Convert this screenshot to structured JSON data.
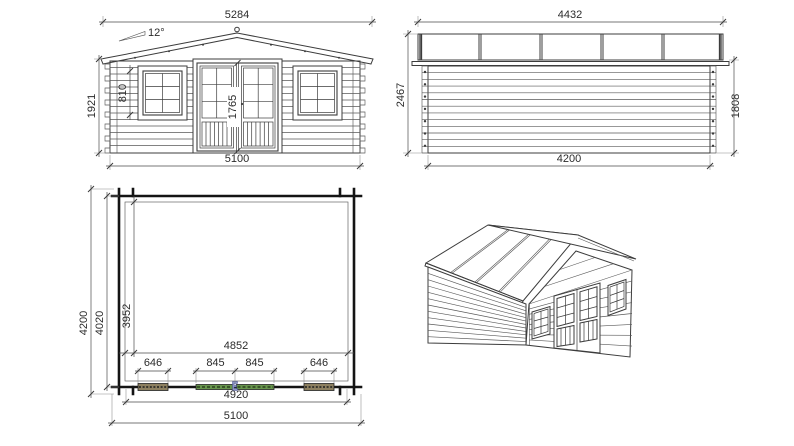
{
  "drawing": {
    "type": "log-cabin technical drawing, four views",
    "views": {
      "front_elevation": {
        "dims": {
          "roof_width": "5284",
          "roof_angle": "12°",
          "wall_height": "1921",
          "window_height": "810",
          "door_height": "1765",
          "wall_width": "5100"
        }
      },
      "side_elevation": {
        "dims": {
          "roof_depth": "4432",
          "overall_height": "2467",
          "wall_height": "1808",
          "wall_depth": "4200"
        }
      },
      "floor_plan": {
        "dims": {
          "overall_depth": "4200",
          "outer_depth": "4020",
          "inner_depth": "3952",
          "inner_width": "4852",
          "window_left_width": "646",
          "door_leaf_left": "845",
          "door_leaf_right": "845",
          "window_right_width": "646",
          "wall_width": "4920",
          "overall_width": "5100"
        }
      },
      "perspective": {}
    },
    "colors": {
      "background": "#ffffff",
      "line": "#3c3c3c",
      "wall": "#141414",
      "dimension": "#4a4a4a",
      "text": "#2b2b2b",
      "door_hatch": "#67944c",
      "window_hatch": "#8d8060",
      "door_marker": "#8e96c4"
    }
  }
}
